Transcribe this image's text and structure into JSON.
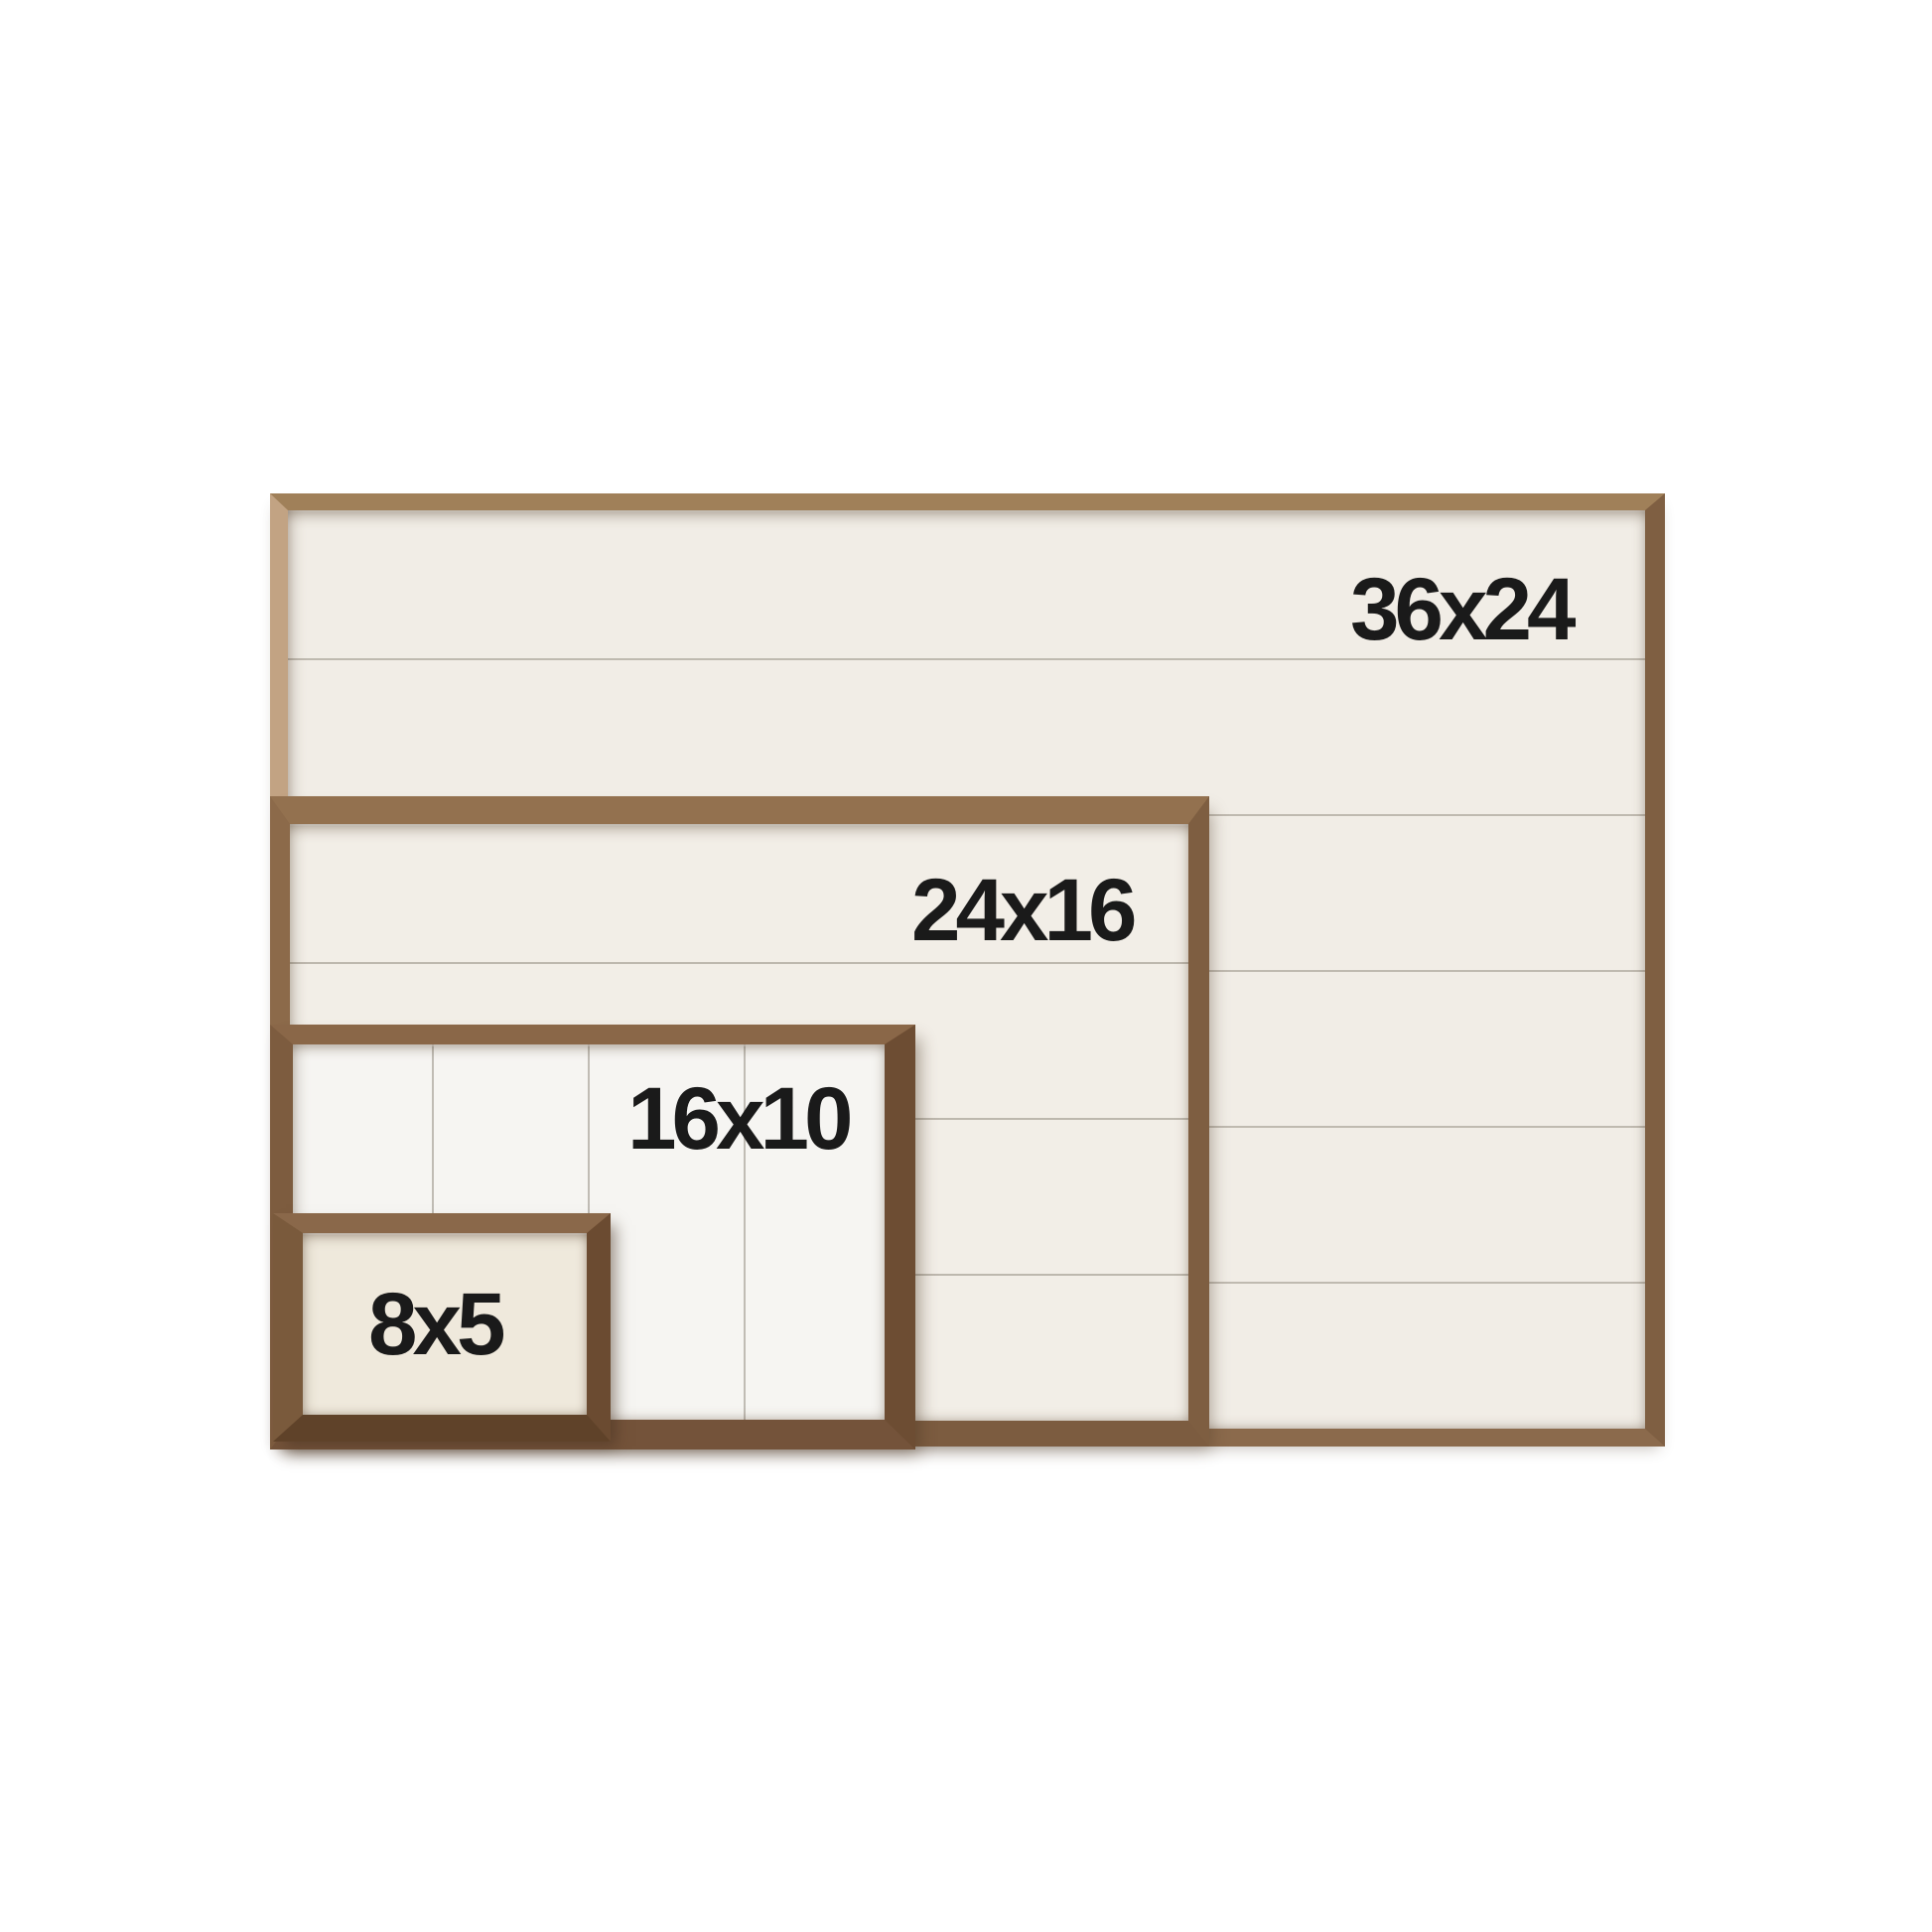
{
  "product_sizes": {
    "background_color": "#ffffff",
    "label_text_color": "#1a1a1a",
    "boards": [
      {
        "label": "36x24",
        "width_in": 36,
        "height_in": 24,
        "plank_direction": "horizontal",
        "plank_line_count": 5,
        "board_color": "#f1ede6",
        "frame_color": "#8b6a4c"
      },
      {
        "label": "24x16",
        "width_in": 24,
        "height_in": 16,
        "plank_direction": "horizontal",
        "plank_line_count": 3,
        "board_color": "#f2eee7",
        "frame_color": "#82604a"
      },
      {
        "label": "16x10",
        "width_in": 16,
        "height_in": 10,
        "plank_direction": "vertical",
        "plank_line_count": 3,
        "board_color": "#f6f5f2",
        "frame_color": "#7a583c"
      },
      {
        "label": "8x5",
        "width_in": 8,
        "height_in": 5,
        "plank_direction": "none",
        "plank_line_count": 0,
        "board_color": "#efe9dc",
        "frame_color": "#74533a"
      }
    ]
  }
}
